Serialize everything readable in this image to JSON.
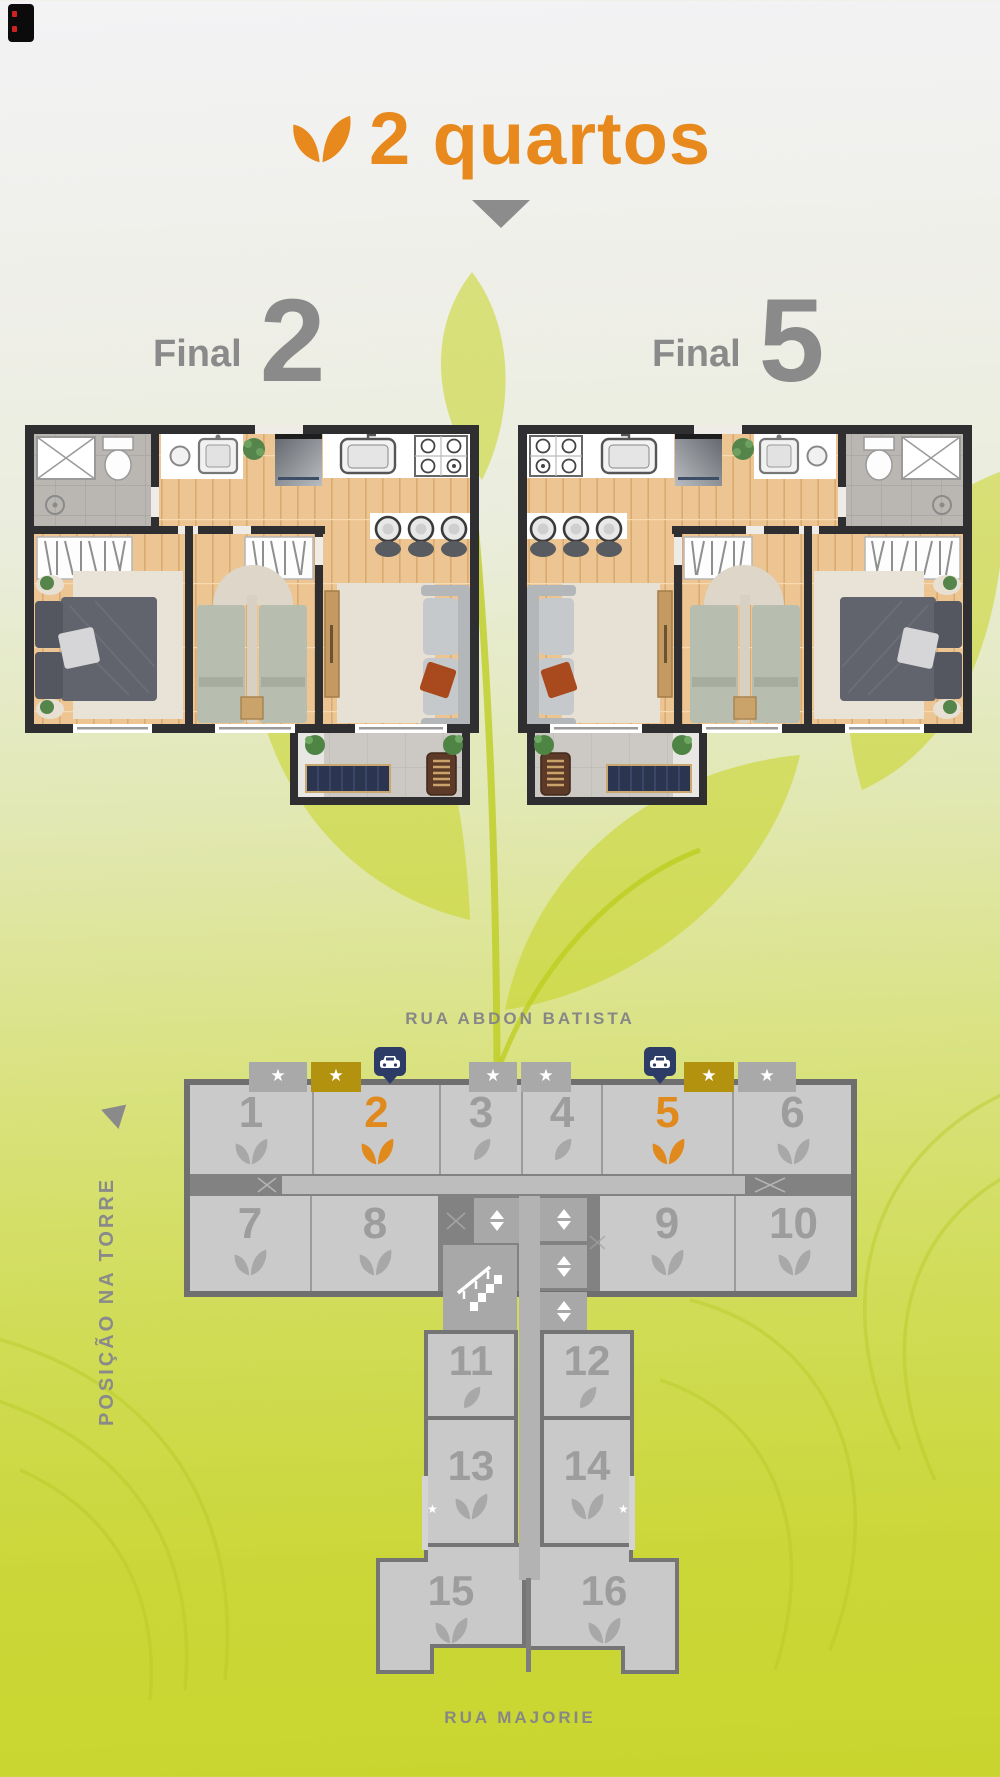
{
  "header": {
    "title": "2 quartos"
  },
  "finals": [
    {
      "word": "Final",
      "digit": "2"
    },
    {
      "word": "Final",
      "digit": "5"
    }
  ],
  "tower": {
    "street_top": "RUA ABDON BATISTA",
    "street_bottom": "RUA MAJORIE",
    "side_label": "POSIÇÃO NA TORRE",
    "units": [
      {
        "number": "1",
        "leaf": "double",
        "highlighted": false,
        "tab": "star-gray"
      },
      {
        "number": "2",
        "leaf": "double",
        "highlighted": true,
        "tab": "star-olive"
      },
      {
        "number": "3",
        "leaf": "single",
        "highlighted": false,
        "tab": "star-gray"
      },
      {
        "number": "4",
        "leaf": "single",
        "highlighted": false,
        "tab": "star-gray"
      },
      {
        "number": "5",
        "leaf": "double",
        "highlighted": true,
        "tab": "star-olive"
      },
      {
        "number": "6",
        "leaf": "double",
        "highlighted": false,
        "tab": "star-gray"
      },
      {
        "number": "7",
        "leaf": "double",
        "highlighted": false
      },
      {
        "number": "8",
        "leaf": "double",
        "highlighted": false
      },
      {
        "number": "9",
        "leaf": "double",
        "highlighted": false
      },
      {
        "number": "10",
        "leaf": "double",
        "highlighted": false
      },
      {
        "number": "11",
        "leaf": "single",
        "highlighted": false
      },
      {
        "number": "12",
        "leaf": "single",
        "highlighted": false
      },
      {
        "number": "13",
        "leaf": "double",
        "highlighted": false,
        "corner_star": true
      },
      {
        "number": "14",
        "leaf": "double",
        "highlighted": false,
        "corner_star": true
      },
      {
        "number": "15",
        "leaf": "double",
        "highlighted": false
      },
      {
        "number": "16",
        "leaf": "double",
        "highlighted": false
      }
    ],
    "icons": {
      "star": "★",
      "up": "▲",
      "down": "▼"
    }
  },
  "colors": {
    "accent_orange": "#e8891d",
    "tab_olive": "#b3920f",
    "pin_navy": "#2c3c66",
    "unit_fill": "#c9c9c9",
    "outline_gray": "#6f6f6f",
    "text_gray": "#8a8a8a"
  }
}
